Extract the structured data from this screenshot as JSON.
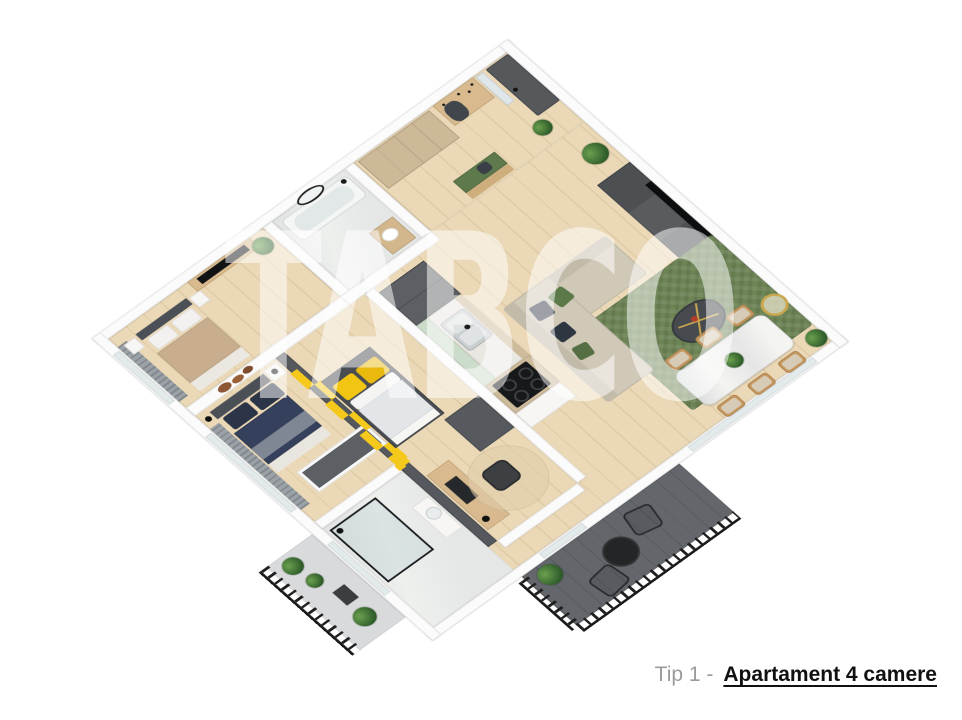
{
  "watermark": {
    "text": "TABCO",
    "color": "#ffffff",
    "opacity": 0.52
  },
  "caption": {
    "type_label": "Tip 1 -",
    "name": "Apartament 4 camere"
  },
  "palette": {
    "background": "#ffffff",
    "wood_floor": "#ead8b6",
    "marble_floor": "#eef0ee",
    "wall_white": "#fbfbfb",
    "wall_cap_dark": "#55595d",
    "accent_yellow": "#f5c91c",
    "rug_green": "#6d8455",
    "sofa_beige": "#d1c9b8",
    "bed_navy": "#35405c",
    "bed_beige": "#c8ad8e",
    "cabinet_beige": "#cdb997",
    "wood_furniture": "#d8ba8e",
    "door_gray": "#56595c",
    "balcony_floor_dark": "#63666b",
    "glass_green": "#ccdccb",
    "cushion_green": "#5e7a4c"
  },
  "rooms": [
    {
      "name": "bedroom-matrimonial"
    },
    {
      "name": "bedroom-2"
    },
    {
      "name": "bedroom-3-office"
    },
    {
      "name": "bathroom-bathtub"
    },
    {
      "name": "bathroom-shower"
    },
    {
      "name": "kitchen"
    },
    {
      "name": "living-room"
    },
    {
      "name": "dining-area"
    },
    {
      "name": "hallway-entry"
    },
    {
      "name": "balcony-west"
    },
    {
      "name": "balcony-south"
    }
  ]
}
